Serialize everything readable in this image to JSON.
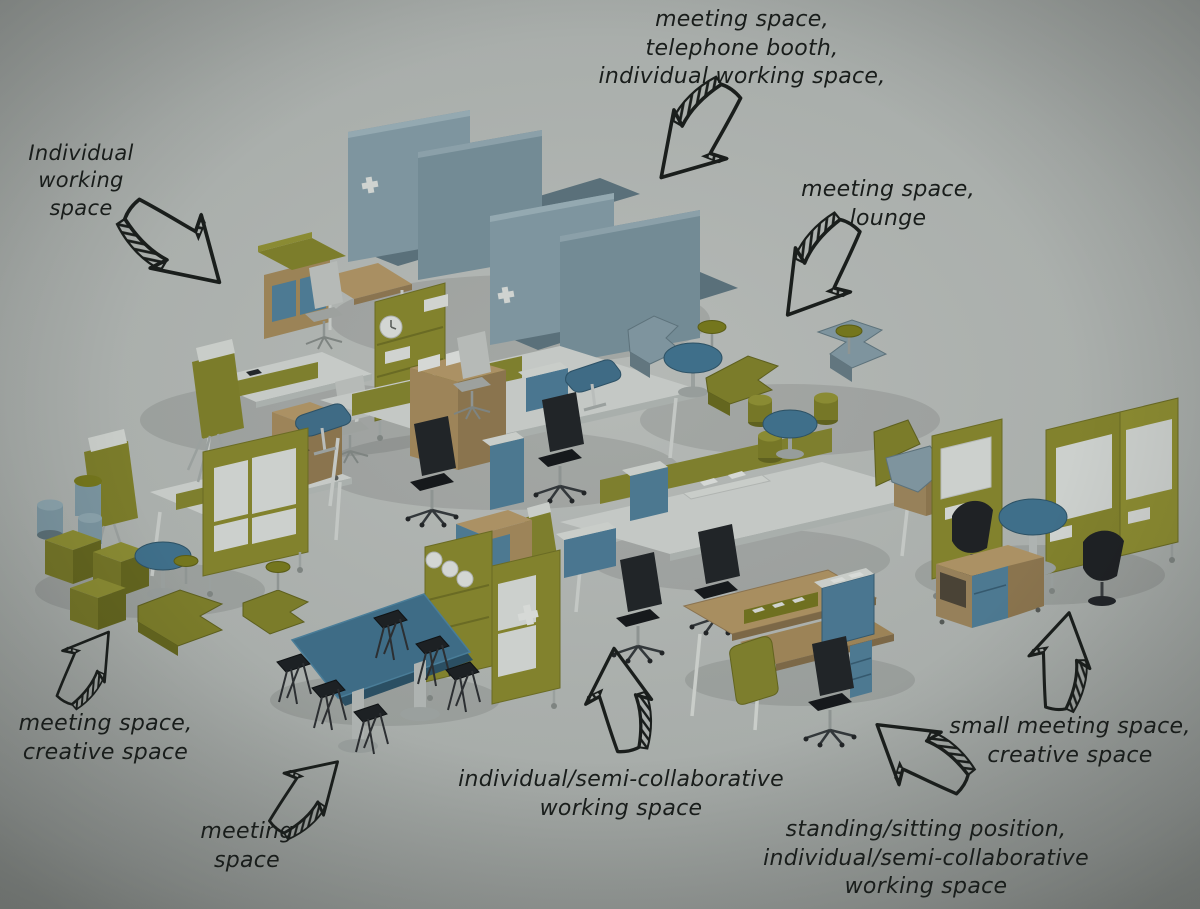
{
  "annotations": [
    {
      "id": "booths",
      "text": "meeting space,\ntelephone booth,\nindividual working space,"
    },
    {
      "id": "individual",
      "text": "Individual\nworking\nspace"
    },
    {
      "id": "lounge",
      "text": "meeting space,\nlounge"
    },
    {
      "id": "creative",
      "text": "meeting space,\ncreative space"
    },
    {
      "id": "meeting",
      "text": "meeting\nspace"
    },
    {
      "id": "semi_collaborative",
      "text": "individual/semi-collaborative\nworking space"
    },
    {
      "id": "standing_sitting",
      "text": "standing/sitting position,\nindividual/semi-collaborative\nworking space"
    },
    {
      "id": "small_meeting",
      "text": "small meeting space,\ncreative space"
    }
  ],
  "palette": {
    "background": "#a9aeab",
    "ink": "#1a1e1c",
    "olive": "#82832d",
    "olive_dark": "#63651f",
    "steel_blue": "#7e949e",
    "table_blue": "#3f6f8a",
    "drawer_blue": "#4d7991",
    "wood": "#a98f62",
    "surface_white": "#c7cbc8",
    "chair_black": "#1e2225",
    "metal_gray": "#9aa09e"
  }
}
